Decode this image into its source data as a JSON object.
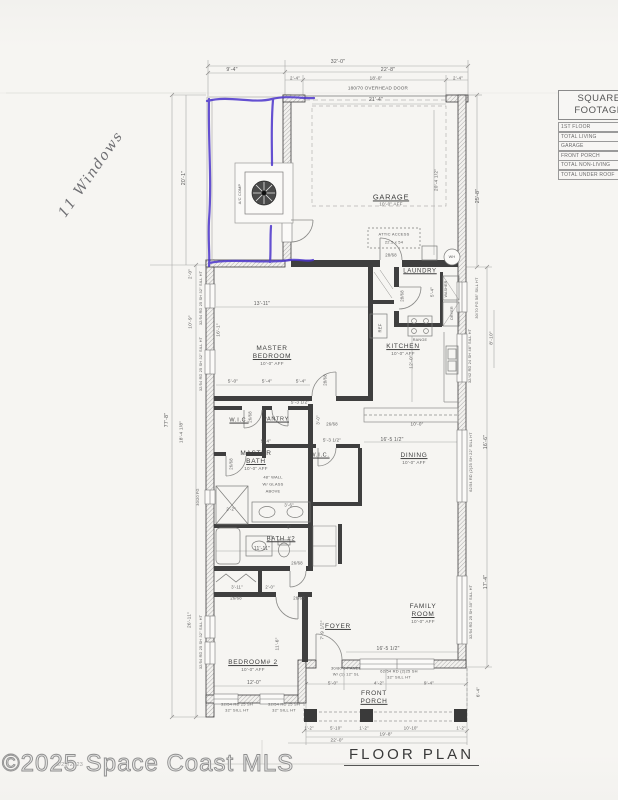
{
  "title": "FLOOR PLAN",
  "scan": {
    "watermark": "©2025 Space Coast MLS",
    "stamp": "9/25/2023",
    "handwritten_note": "11 Windows",
    "pen_color": "#4b34cc"
  },
  "sqft_table": {
    "title_line1": "SQUARE",
    "title_line2": "FOOTAGE",
    "rows": [
      "1ST FLOOR",
      "TOTAL LIVING",
      "GARAGE",
      "FRONT PORCH",
      "TOTAL NON-LIVING",
      "TOTAL UNDER ROOF"
    ]
  },
  "rooms": [
    {
      "name": "GARAGE",
      "sub": "10'-0\" AFF",
      "x": 391,
      "y": 200,
      "s": 7.5
    },
    {
      "name": "LAUNDRY",
      "x": 420,
      "y": 272,
      "s": 6
    },
    {
      "name": "KITCHEN",
      "sub": "10'-0\" AFF",
      "x": 403,
      "y": 350
    },
    {
      "name": "MASTER\nBEDROOM",
      "sub": "10'-0\" AFF",
      "x": 272,
      "y": 356
    },
    {
      "name": "W.I.C.",
      "x": 239,
      "y": 421,
      "s": 5.5
    },
    {
      "name": "PANTRY",
      "x": 276,
      "y": 420,
      "s": 5.5
    },
    {
      "name": "MASTER\nBATH",
      "sub": "10'-0\" AFF",
      "x": 256,
      "y": 461
    },
    {
      "name": "W.I.C.",
      "x": 320,
      "y": 456,
      "s": 5.5
    },
    {
      "name": "DINING",
      "sub": "10'-0\" AFF",
      "x": 414,
      "y": 459
    },
    {
      "name": "BATH #2",
      "x": 281,
      "y": 540,
      "s": 6
    },
    {
      "name": "BEDROOM# 2",
      "sub": "10'-0\" AFF",
      "x": 253,
      "y": 666
    },
    {
      "name": "FOYER",
      "x": 338,
      "y": 627
    },
    {
      "name": "FAMILY\nROOM",
      "sub": "10'-0\" AFF",
      "x": 423,
      "y": 614
    },
    {
      "name": "FRONT\nPORCH",
      "x": 374,
      "y": 698
    }
  ],
  "dims": [
    {
      "t": "32'-0\"",
      "x": 338,
      "y": 62
    },
    {
      "t": "9'-4\"",
      "x": 232,
      "y": 70
    },
    {
      "t": "22'-8\"",
      "x": 388,
      "y": 70
    },
    {
      "t": "2'-4\"",
      "x": 295,
      "y": 78,
      "s": 4.5
    },
    {
      "t": "18'-0\"",
      "x": 376,
      "y": 78,
      "s": 4.5
    },
    {
      "t": "2'-4\"",
      "x": 458,
      "y": 78,
      "s": 4.5
    },
    {
      "t": "180/70 OVERHEAD DOOR",
      "x": 378,
      "y": 88,
      "s": 4.6
    },
    {
      "t": "21'-4\"",
      "x": 376,
      "y": 100,
      "s": 5
    },
    {
      "t": "20'-1\"",
      "x": 184,
      "y": 178,
      "r": -90
    },
    {
      "t": "77'-8\"",
      "x": 167,
      "y": 420,
      "r": -90
    },
    {
      "t": "20'-4 1/2\"",
      "x": 437,
      "y": 180,
      "r": -90,
      "s": 4.8
    },
    {
      "t": "25'-8\"",
      "x": 478,
      "y": 196,
      "r": -90
    },
    {
      "t": "2'-0\"",
      "x": 190,
      "y": 274,
      "r": -90,
      "s": 4.5
    },
    {
      "t": "32/54 RD 25 SH 32\" SILL HT",
      "x": 201,
      "y": 298,
      "r": -90,
      "s": 3.8
    },
    {
      "t": "10'-9\"",
      "x": 191,
      "y": 322,
      "r": -90,
      "s": 4.8
    },
    {
      "t": "16'-1\"",
      "x": 219,
      "y": 330,
      "r": -90,
      "s": 4.8
    },
    {
      "t": "32/54 RD 25 SH 32\" SILL HT",
      "x": 201,
      "y": 364,
      "r": -90,
      "s": 3.8
    },
    {
      "t": "18'-4 1/8\"",
      "x": 182,
      "y": 432,
      "r": -90,
      "s": 4.8
    },
    {
      "t": "30/20 FG",
      "x": 198,
      "y": 497,
      "r": -90,
      "s": 3.8
    },
    {
      "t": "26'-11\"",
      "x": 190,
      "y": 620,
      "r": -90,
      "s": 4.8
    },
    {
      "t": "32/54 RD 25 SH 32\" SILL HT",
      "x": 201,
      "y": 642,
      "r": -90,
      "s": 3.8
    },
    {
      "t": "13'-11\"",
      "x": 262,
      "y": 304,
      "s": 5
    },
    {
      "t": "5'-0\"",
      "x": 233,
      "y": 382,
      "s": 4.8
    },
    {
      "t": "5'-4\"",
      "x": 267,
      "y": 382,
      "s": 4.8
    },
    {
      "t": "5'-4\"",
      "x": 301,
      "y": 382,
      "s": 4.8
    },
    {
      "t": "28/68",
      "x": 325,
      "y": 380,
      "r": -90,
      "s": 4.2
    },
    {
      "t": "REF",
      "x": 380,
      "y": 328,
      "r": -90,
      "s": 4.2
    },
    {
      "t": "RANGE",
      "x": 420,
      "y": 340,
      "s": 3.8
    },
    {
      "t": "28/68",
      "x": 391,
      "y": 255,
      "s": 4.2
    },
    {
      "t": "WH",
      "x": 452,
      "y": 257,
      "s": 3.8
    },
    {
      "t": "28/68",
      "x": 402,
      "y": 296,
      "r": -90,
      "s": 4.2
    },
    {
      "t": "5'-4\"",
      "x": 432,
      "y": 292,
      "r": -90,
      "s": 4.5
    },
    {
      "t": "WASHER",
      "x": 446,
      "y": 289,
      "r": -90,
      "s": 3.6
    },
    {
      "t": "DRYER",
      "x": 452,
      "y": 313,
      "r": -90,
      "s": 3.6
    },
    {
      "t": "30/70 FG 58\" SILL HT",
      "x": 477,
      "y": 298,
      "r": -90,
      "s": 3.8
    },
    {
      "t": "32/42 RD 24 SH 46\" SILL HT",
      "x": 470,
      "y": 356,
      "r": -90,
      "s": 3.8
    },
    {
      "t": "8'-10\"",
      "x": 492,
      "y": 338,
      "r": -90,
      "s": 4.8
    },
    {
      "t": "12'-0\"",
      "x": 412,
      "y": 362,
      "r": -90,
      "s": 4.8
    },
    {
      "t": "ATTIC ACCESS",
      "x": 394,
      "y": 234,
      "s": 4
    },
    {
      "t": "22.5 x 54",
      "x": 394,
      "y": 242,
      "s": 4
    },
    {
      "t": "26/68",
      "x": 250,
      "y": 417,
      "r": -90,
      "s": 4.2
    },
    {
      "t": "5'-3 1/2\"",
      "x": 300,
      "y": 402,
      "s": 4.5
    },
    {
      "t": "3'-0\"",
      "x": 318,
      "y": 420,
      "r": -90,
      "s": 4.2
    },
    {
      "t": "26/68",
      "x": 332,
      "y": 424,
      "s": 4.2
    },
    {
      "t": "5'-4\"",
      "x": 266,
      "y": 441,
      "s": 4.5
    },
    {
      "t": "5'-3 1/2\"",
      "x": 332,
      "y": 440,
      "s": 4.5
    },
    {
      "t": "26/68",
      "x": 231,
      "y": 464,
      "r": -90,
      "s": 4.2
    },
    {
      "t": "48\" WALL",
      "x": 273,
      "y": 477,
      "s": 4
    },
    {
      "t": "W/ GLASS",
      "x": 273,
      "y": 484,
      "s": 4
    },
    {
      "t": "ABOVE",
      "x": 273,
      "y": 491,
      "s": 4
    },
    {
      "t": "2'-2\"",
      "x": 231,
      "y": 509,
      "s": 4.2
    },
    {
      "t": "3'-6\"",
      "x": 289,
      "y": 505,
      "s": 4.2
    },
    {
      "t": "5'",
      "x": 289,
      "y": 527,
      "s": 4.2
    },
    {
      "t": "11'-11\"",
      "x": 262,
      "y": 549,
      "s": 5
    },
    {
      "t": "3'-11\"",
      "x": 237,
      "y": 587,
      "s": 4.2
    },
    {
      "t": "2'-0\"",
      "x": 270,
      "y": 587,
      "s": 4.2
    },
    {
      "t": "26/68",
      "x": 236,
      "y": 598,
      "s": 4.2
    },
    {
      "t": "26/68",
      "x": 297,
      "y": 563,
      "s": 4.2
    },
    {
      "t": "26/68",
      "x": 299,
      "y": 598,
      "s": 4.2
    },
    {
      "t": "12'-0\"",
      "x": 254,
      "y": 683,
      "s": 5
    },
    {
      "t": "11'-6\"",
      "x": 278,
      "y": 644,
      "r": -90,
      "s": 4.8
    },
    {
      "t": "7'-9 1/2\"",
      "x": 323,
      "y": 630,
      "r": -90,
      "s": 4.8
    },
    {
      "t": "16'-5 1/2\"",
      "x": 388,
      "y": 649,
      "s": 5
    },
    {
      "t": "16'-5 1/2\"",
      "x": 392,
      "y": 440,
      "s": 5
    },
    {
      "t": "10'-0\"",
      "x": 417,
      "y": 424,
      "s": 4.6
    },
    {
      "t": "62/54 RD (2)25 SH 22\" SILL HT",
      "x": 471,
      "y": 462,
      "r": -90,
      "s": 3.8
    },
    {
      "t": "16'-6\"",
      "x": 486,
      "y": 442,
      "r": -90
    },
    {
      "t": "32/54 RD 25 SH 30\" SILL HT",
      "x": 471,
      "y": 612,
      "r": -90,
      "s": 3.8
    },
    {
      "t": "17'-4\"",
      "x": 486,
      "y": 582,
      "r": -90
    },
    {
      "t": "30/80 6-PANEL",
      "x": 346,
      "y": 668,
      "s": 4
    },
    {
      "t": "W/ (1) 12\" SL",
      "x": 346,
      "y": 674,
      "s": 4
    },
    {
      "t": "5'-0\"",
      "x": 333,
      "y": 683,
      "s": 4.6
    },
    {
      "t": "4'-2\"",
      "x": 379,
      "y": 683,
      "s": 4.6
    },
    {
      "t": "9'-4\"",
      "x": 429,
      "y": 683,
      "s": 4.6
    },
    {
      "t": "62/54 RD (2)25 SH",
      "x": 399,
      "y": 671,
      "s": 4
    },
    {
      "t": "32\" SILL HT",
      "x": 399,
      "y": 677,
      "s": 4
    },
    {
      "t": "32/54 RD 25 SH",
      "x": 237,
      "y": 704,
      "s": 4
    },
    {
      "t": "32\" SILL HT",
      "x": 237,
      "y": 710,
      "s": 4
    },
    {
      "t": "32/54 RD 25 SH",
      "x": 284,
      "y": 704,
      "s": 4
    },
    {
      "t": "32\" SILL HT",
      "x": 284,
      "y": 710,
      "s": 4
    },
    {
      "t": "6'-4\"",
      "x": 478,
      "y": 692,
      "r": -90,
      "s": 4.6
    },
    {
      "t": "1'-2\"",
      "x": 309,
      "y": 728,
      "s": 4.2
    },
    {
      "t": "5'-10\"",
      "x": 336,
      "y": 728,
      "s": 4.2
    },
    {
      "t": "1'-2\"",
      "x": 364,
      "y": 728,
      "s": 4.2
    },
    {
      "t": "10'-10\"",
      "x": 411,
      "y": 728,
      "s": 4.2
    },
    {
      "t": "1'-2\"",
      "x": 461,
      "y": 728,
      "s": 4.2
    },
    {
      "t": "19'-8\"",
      "x": 386,
      "y": 734,
      "s": 4.6
    },
    {
      "t": "22'-0\"",
      "x": 337,
      "y": 740,
      "s": 4.6
    },
    {
      "t": "A/C COMP",
      "x": 240,
      "y": 194,
      "r": -90,
      "s": 3.8
    }
  ]
}
